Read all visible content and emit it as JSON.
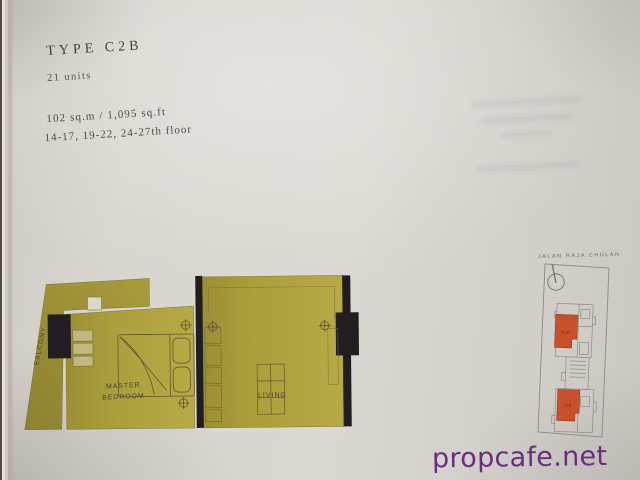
{
  "header": {
    "title": "TYPE C2B",
    "unit_count": "21 units",
    "area": "102 sq.m / 1,095 sq.ft",
    "floors": "14-17, 19-22, 24-27th floor"
  },
  "floorplan": {
    "labels": {
      "balcony": "BALCONY",
      "master_bedroom_line1": "MASTER",
      "master_bedroom_line2": "BEDROOM",
      "living": "LIVING"
    },
    "colors": {
      "room_fill": "#ada03b",
      "wall": "#221d20"
    }
  },
  "keyplan": {
    "street": "JALAN RAJA CHULAN",
    "unit_label": "C2B",
    "highlight_color": "#c8502c"
  },
  "watermark": {
    "text": "propcafe.net",
    "color": "#66307f"
  }
}
